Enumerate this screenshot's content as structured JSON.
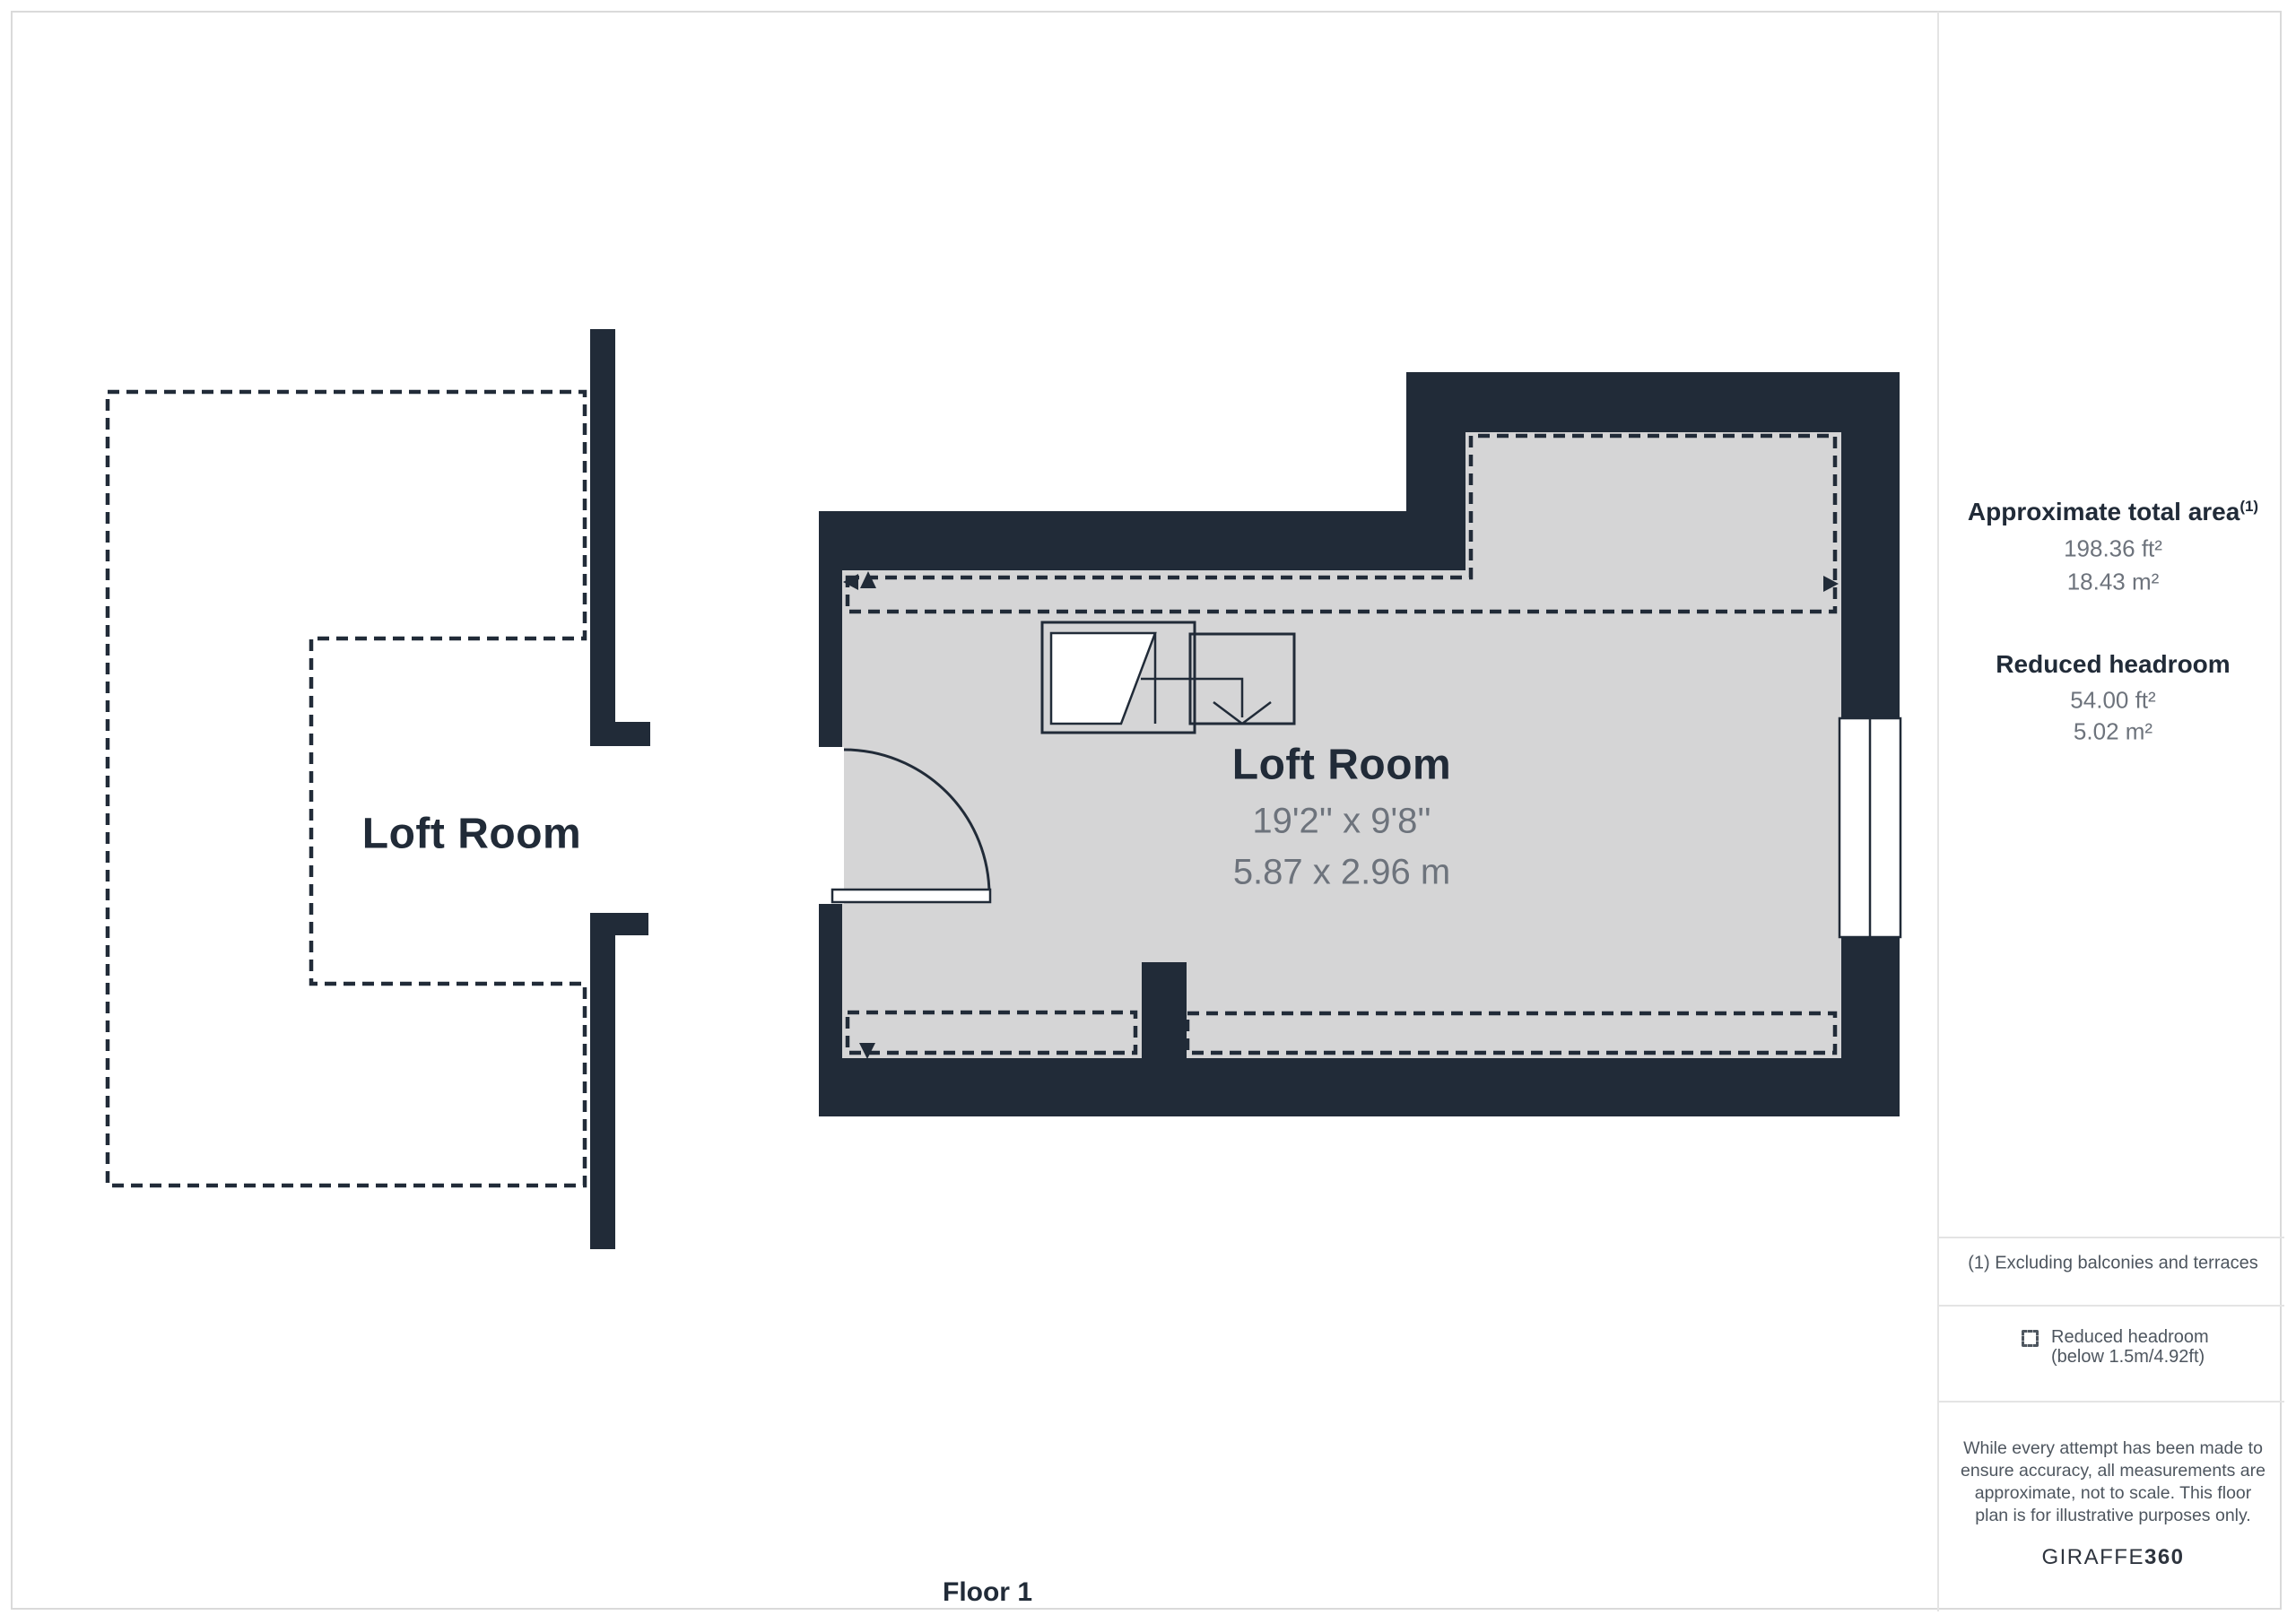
{
  "plan": {
    "floor_label": "Floor 1",
    "left_room": {
      "label": "Loft Room"
    },
    "main_room": {
      "label": "Loft Room",
      "dimensions_imperial": "19'2'' x 9'8''",
      "dimensions_metric": "5.87 x 2.96 m"
    }
  },
  "sidebar": {
    "total_area": {
      "title": "Approximate total area",
      "superscript": "(1)",
      "value_imperial": "198.36 ft²",
      "value_metric": "18.43 m²"
    },
    "reduced_headroom": {
      "title": "Reduced headroom",
      "value_imperial": "54.00 ft²",
      "value_metric": "5.02 m²"
    },
    "footnote": "(1) Excluding balconies and terraces",
    "legend": {
      "line1": "Reduced headroom",
      "line2": "(below 1.5m/4.92ft)"
    },
    "disclaimer": "While every attempt has been made to ensure accuracy, all measurements are approximate, not to scale. This floor plan is for illustrative purposes only.",
    "brand": {
      "name": "GIRAFFE",
      "suffix": "360"
    }
  },
  "colors": {
    "wall": "#212b38",
    "floor": "#d5d5d6",
    "dim_text": "#6d737c",
    "muted_text": "#4e565f",
    "divider": "#e4e4e4"
  }
}
